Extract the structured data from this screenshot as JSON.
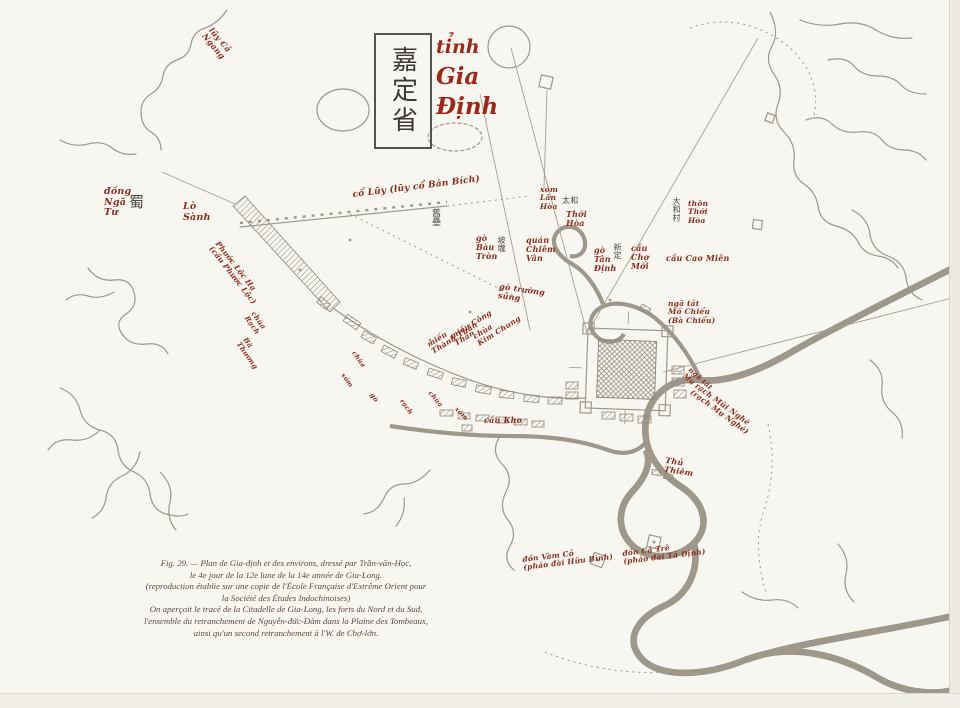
{
  "title": {
    "chinese": "嘉定省",
    "viet_lines": [
      "tỉnh",
      "Gia",
      "Định"
    ]
  },
  "caption": {
    "lines": [
      "Fig. 29. — Plan de Gia-định et des environs, dressé par Trần-văn-Học,",
      "le 4e jour de la 12e lune de la 14e année de Gia-Long.",
      "(reproduction établie sur une copie de l'École Française d'Extrême Orient pour",
      "la Société des Études Indochinoises)",
      "On aperçoit le tracé de la Citadelle de Gia-Long, les forts du Nord et du Sud,",
      "l'ensemble du retranchement de Nguyễn-đức-Đàm dans la Plaine des Tombeaux,",
      "ainsi qu'un second retranchement à l'W. de Chợ-lớn."
    ]
  },
  "colors": {
    "paper": "#f8f6f1",
    "map_line": "#9d978c",
    "label_red": "#8c2c1b",
    "title_red": "#9c2818",
    "ink": "#4c463f",
    "caption": "#5a4a3c"
  },
  "map": {
    "labels": [
      {
        "text": "lũy Cả\nNgang",
        "x": 214,
        "y": 26,
        "rot": 50,
        "fs": 8
      },
      {
        "text": "đồng\nNgã\nTư",
        "x": 104,
        "y": 187,
        "fs": 9.5
      },
      {
        "text": "蜀",
        "x": 129,
        "y": 194,
        "fs": 15,
        "cls": "ink"
      },
      {
        "text": "Lò\nSành",
        "x": 183,
        "y": 202,
        "fs": 9.5
      },
      {
        "text": "Phước Lộc Hạ\n(cầu Phước Lộc)",
        "x": 220,
        "y": 240,
        "rot": 52,
        "fs": 7.5
      },
      {
        "text": "chùa\nRạch",
        "x": 256,
        "y": 310,
        "rot": 55,
        "fs": 7
      },
      {
        "text": "Bà\nThương",
        "x": 248,
        "y": 336,
        "rot": 55,
        "fs": 7
      },
      {
        "text": "cổ Lũy (lũy cổ Bán Bích)",
        "x": 352,
        "y": 190,
        "rot": -7,
        "fs": 9
      },
      {
        "text": "舊壘",
        "x": 430,
        "y": 208,
        "fs": 9,
        "cls": "ink",
        "vert": true
      },
      {
        "text": "gò\nBàu\nTròn",
        "x": 476,
        "y": 234,
        "fs": 8
      },
      {
        "text": "坡壠",
        "x": 497,
        "y": 236,
        "fs": 8,
        "cls": "ink",
        "vert": true
      },
      {
        "text": "quán\nChiêm\nVân",
        "x": 526,
        "y": 236,
        "fs": 8
      },
      {
        "text": "xóm\nLân\nHòa",
        "x": 540,
        "y": 186,
        "fs": 7.5
      },
      {
        "text": "太和",
        "x": 562,
        "y": 197,
        "fs": 8,
        "cls": "ink"
      },
      {
        "text": "Thới\nHòa",
        "x": 566,
        "y": 210,
        "fs": 8
      },
      {
        "text": "gò trường\nsúng",
        "x": 500,
        "y": 282,
        "rot": 8,
        "fs": 8
      },
      {
        "text": "大和村",
        "x": 672,
        "y": 197,
        "fs": 8,
        "cls": "ink",
        "vert": true
      },
      {
        "text": "thôn\nThới\nHòa",
        "x": 688,
        "y": 200,
        "fs": 7.5
      },
      {
        "text": "新定",
        "x": 613,
        "y": 243,
        "fs": 8,
        "cls": "ink",
        "vert": true
      },
      {
        "text": "gò\nTân\nĐịnh",
        "x": 594,
        "y": 246,
        "fs": 8
      },
      {
        "text": "cầu\nChợ\nMới",
        "x": 631,
        "y": 244,
        "fs": 8
      },
      {
        "text": "cầu Cao Miên",
        "x": 666,
        "y": 254,
        "fs": 8
      },
      {
        "text": "ngã tắt\nMồ Chiểu\n(Bà Chiểu)",
        "x": 668,
        "y": 300,
        "fs": 7.5
      },
      {
        "text": "miếu\nThành Thần",
        "x": 426,
        "y": 342,
        "rot": -32,
        "fs": 7.5
      },
      {
        "text": "miếu Công\nThần",
        "x": 449,
        "y": 334,
        "rot": -32,
        "fs": 7.5
      },
      {
        "text": "chùa\nKim Chung",
        "x": 472,
        "y": 334,
        "rot": -32,
        "fs": 7.5
      },
      {
        "text": "chùa",
        "x": 356,
        "y": 350,
        "rot": 55,
        "fs": 6.5
      },
      {
        "text": "xóm",
        "x": 345,
        "y": 372,
        "rot": 55,
        "fs": 6.5
      },
      {
        "text": "gò",
        "x": 374,
        "y": 392,
        "rot": 55,
        "fs": 6.5
      },
      {
        "text": "rạch",
        "x": 404,
        "y": 398,
        "rot": 55,
        "fs": 6.5
      },
      {
        "text": "chùa",
        "x": 432,
        "y": 390,
        "rot": 50,
        "fs": 6.5
      },
      {
        "text": "xóm",
        "x": 458,
        "y": 406,
        "rot": 45,
        "fs": 6.5
      },
      {
        "text": "cầu Kho",
        "x": 484,
        "y": 416,
        "fs": 8
      },
      {
        "text": "ngã tắt\nMụ",
        "x": 692,
        "y": 366,
        "rot": 42,
        "fs": 7
      },
      {
        "text": "rạch Mũi Nghé\n(rạch Mụ Nghé)",
        "x": 698,
        "y": 382,
        "rot": 36,
        "fs": 7.5
      },
      {
        "text": "Thủ\nThiêm",
        "x": 666,
        "y": 456,
        "rot": 8,
        "fs": 8
      },
      {
        "text": "đồn Vàm Cỏ\n(pháo đài Hữu Bình)",
        "x": 522,
        "y": 556,
        "rot": -7,
        "fs": 7.5
      },
      {
        "text": "đồn Cá Trê\n(pháo đài Tả Định)",
        "x": 622,
        "y": 550,
        "rot": -7,
        "fs": 7.5
      }
    ]
  }
}
